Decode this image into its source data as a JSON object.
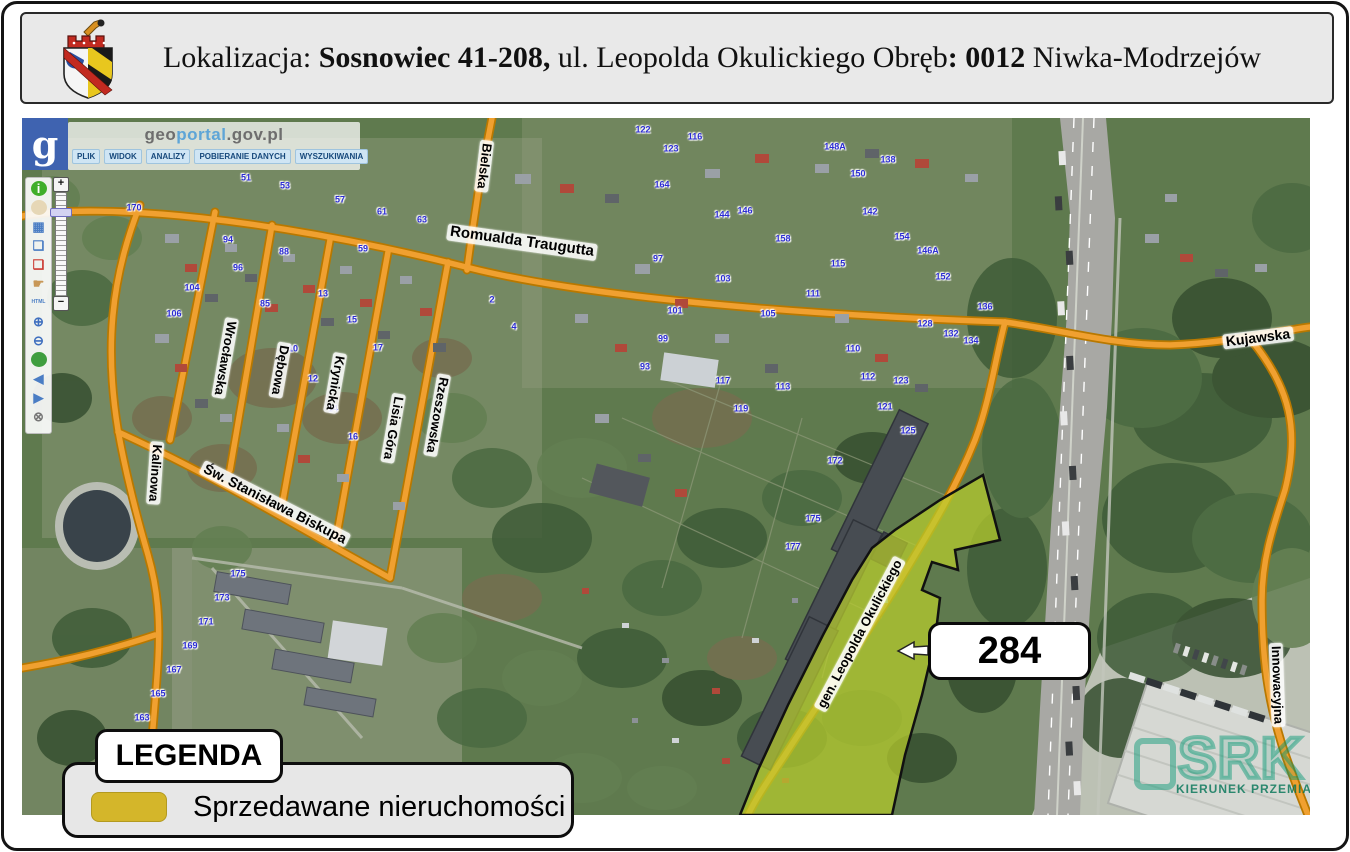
{
  "header": {
    "title_parts": [
      {
        "text": "Lokalizacja: ",
        "bold": false
      },
      {
        "text": "Sosnowiec 41-208,",
        "bold": true
      },
      {
        "text": " ul. Leopolda Okulickiego Obręb",
        "bold": false
      },
      {
        "text": ": 0012",
        "bold": true
      },
      {
        "text": " Niwka-Modrzejów",
        "bold": false
      }
    ]
  },
  "geoportal": {
    "logo_letter": "g",
    "title": {
      "part1": "geo",
      "part2": "portal",
      "part3": ".gov.pl"
    },
    "menu": [
      "PLIK",
      "WIDOK",
      "ANALIZY",
      "POBIERANIE DANYCH",
      "WYSZUKIWANIA"
    ]
  },
  "toolbar": {
    "icons": [
      {
        "name": "info-icon",
        "glyph": "i",
        "fg": "#ffffff",
        "bg": "#3fae2a",
        "round": true
      },
      {
        "name": "measure-icon",
        "glyph": "",
        "fg": "#8a6f46",
        "bg": "#e6d7b6",
        "round": true
      },
      {
        "name": "layers-icon",
        "glyph": "▦",
        "fg": "#4a7dc4",
        "bg": ""
      },
      {
        "name": "select-add-icon",
        "glyph": "❏",
        "fg": "#4a7dc4",
        "bg": ""
      },
      {
        "name": "select-remove-icon",
        "glyph": "❏",
        "fg": "#cc3b33",
        "bg": ""
      },
      {
        "name": "pan-hand-icon",
        "glyph": "☛",
        "fg": "#c89858",
        "bg": ""
      },
      {
        "name": "html-icon",
        "glyph": "HTML",
        "fg": "#4a7dc4",
        "bg": "",
        "small": true
      },
      {
        "name": "zoom-in-icon",
        "glyph": "⊕",
        "fg": "#3f6fbf",
        "bg": ""
      },
      {
        "name": "zoom-out-icon",
        "glyph": "⊖",
        "fg": "#3f6fbf",
        "bg": ""
      },
      {
        "name": "full-extent-icon",
        "glyph": "",
        "fg": "#ffffff",
        "bg": "#3f9e3f",
        "round": true
      },
      {
        "name": "prev-view-icon",
        "glyph": "◀",
        "fg": "#4a7dc4",
        "bg": ""
      },
      {
        "name": "next-view-icon",
        "glyph": "▶",
        "fg": "#4a7dc4",
        "bg": ""
      },
      {
        "name": "close-icon",
        "glyph": "⊗",
        "fg": "#777777",
        "bg": ""
      }
    ]
  },
  "zoom_control": {
    "plus": "+",
    "minus": "−"
  },
  "map": {
    "street_labels": [
      {
        "t": "Bielska",
        "x": 462,
        "y": 48,
        "r": 97
      },
      {
        "t": "Romualda Traugutta",
        "x": 500,
        "y": 124,
        "r": 8,
        "s": 15
      },
      {
        "t": "Wrocławska",
        "x": 203,
        "y": 240,
        "r": 100
      },
      {
        "t": "Dębowa",
        "x": 258,
        "y": 252,
        "r": 100
      },
      {
        "t": "Krynicka",
        "x": 313,
        "y": 265,
        "r": 100
      },
      {
        "t": "Lisia Góra",
        "x": 371,
        "y": 310,
        "r": 100
      },
      {
        "t": "Rzeszowska",
        "x": 415,
        "y": 297,
        "r": 100
      },
      {
        "t": "Kalinowa",
        "x": 133,
        "y": 355,
        "r": 94
      },
      {
        "t": "Św. Stanisława Biskupa",
        "x": 253,
        "y": 386,
        "r": 27,
        "s": 14
      },
      {
        "t": "Kujawska",
        "x": 1236,
        "y": 220,
        "r": -7,
        "s": 14
      },
      {
        "t": "Innowacyjna",
        "x": 1255,
        "y": 567,
        "r": 88
      },
      {
        "t": "gen. Leopolda Okulickiego",
        "x": 838,
        "y": 516,
        "r": -62
      }
    ],
    "house_numbers": [
      [
        "170",
        112,
        90
      ],
      [
        "104",
        170,
        170
      ],
      [
        "106",
        152,
        196
      ],
      [
        "94",
        206,
        122
      ],
      [
        "96",
        216,
        150
      ],
      [
        "88",
        262,
        134
      ],
      [
        "85",
        243,
        186
      ],
      [
        "51",
        224,
        60
      ],
      [
        "53",
        263,
        68
      ],
      [
        "57",
        318,
        82
      ],
      [
        "61",
        360,
        94
      ],
      [
        "63",
        400,
        102
      ],
      [
        "59",
        341,
        131
      ],
      [
        "13",
        301,
        176
      ],
      [
        "15",
        330,
        202
      ],
      [
        "17",
        356,
        230
      ],
      [
        "10",
        271,
        231
      ],
      [
        "12",
        291,
        261
      ],
      [
        "14",
        311,
        291
      ],
      [
        "16",
        331,
        319
      ],
      [
        "2",
        470,
        182
      ],
      [
        "4",
        492,
        209
      ],
      [
        "164",
        640,
        67
      ],
      [
        "142",
        848,
        94
      ],
      [
        "154",
        880,
        119
      ],
      [
        "146A",
        906,
        133
      ],
      [
        "144",
        700,
        97
      ],
      [
        "146",
        723,
        93
      ],
      [
        "158",
        761,
        121
      ],
      [
        "122",
        621,
        12
      ],
      [
        "123",
        649,
        31
      ],
      [
        "116",
        673,
        19
      ],
      [
        "148A",
        813,
        29
      ],
      [
        "150",
        836,
        56
      ],
      [
        "138",
        866,
        42
      ],
      [
        "97",
        636,
        141
      ],
      [
        "103",
        701,
        161
      ],
      [
        "105",
        746,
        196
      ],
      [
        "111",
        791,
        176
      ],
      [
        "115",
        816,
        146
      ],
      [
        "113",
        761,
        269
      ],
      [
        "110",
        831,
        231
      ],
      [
        "112",
        846,
        259
      ],
      [
        "117",
        701,
        263
      ],
      [
        "119",
        719,
        291
      ],
      [
        "101",
        653,
        193
      ],
      [
        "99",
        641,
        221
      ],
      [
        "93",
        623,
        249
      ],
      [
        "121",
        863,
        289
      ],
      [
        "123",
        879,
        263
      ],
      [
        "125",
        886,
        313
      ],
      [
        "128",
        903,
        206
      ],
      [
        "132",
        929,
        216
      ],
      [
        "134",
        949,
        223
      ],
      [
        "136",
        963,
        189
      ],
      [
        "152",
        921,
        159
      ],
      [
        "172",
        813,
        343
      ],
      [
        "175",
        791,
        401
      ],
      [
        "177",
        771,
        429
      ],
      [
        "163",
        120,
        600
      ],
      [
        "165",
        136,
        576
      ],
      [
        "167",
        152,
        552
      ],
      [
        "169",
        168,
        528
      ],
      [
        "171",
        184,
        504
      ],
      [
        "173",
        200,
        480
      ],
      [
        "175",
        216,
        456
      ]
    ]
  },
  "parcel": {
    "label": "284",
    "fill_color": "#b9cd2d"
  },
  "legend": {
    "title": "LEGENDA",
    "items": [
      {
        "label": "Sprzedawane nieruchomości",
        "color": "#d4b62a"
      }
    ]
  },
  "watermark": {
    "text": "SRK",
    "subtext": "KIERUNEK PRZEMIAN"
  },
  "colors": {
    "road_fill": "#f0a030",
    "road_edge": "#b87800",
    "highway": "#a8a8a4",
    "parcel_outline": "#111111"
  }
}
